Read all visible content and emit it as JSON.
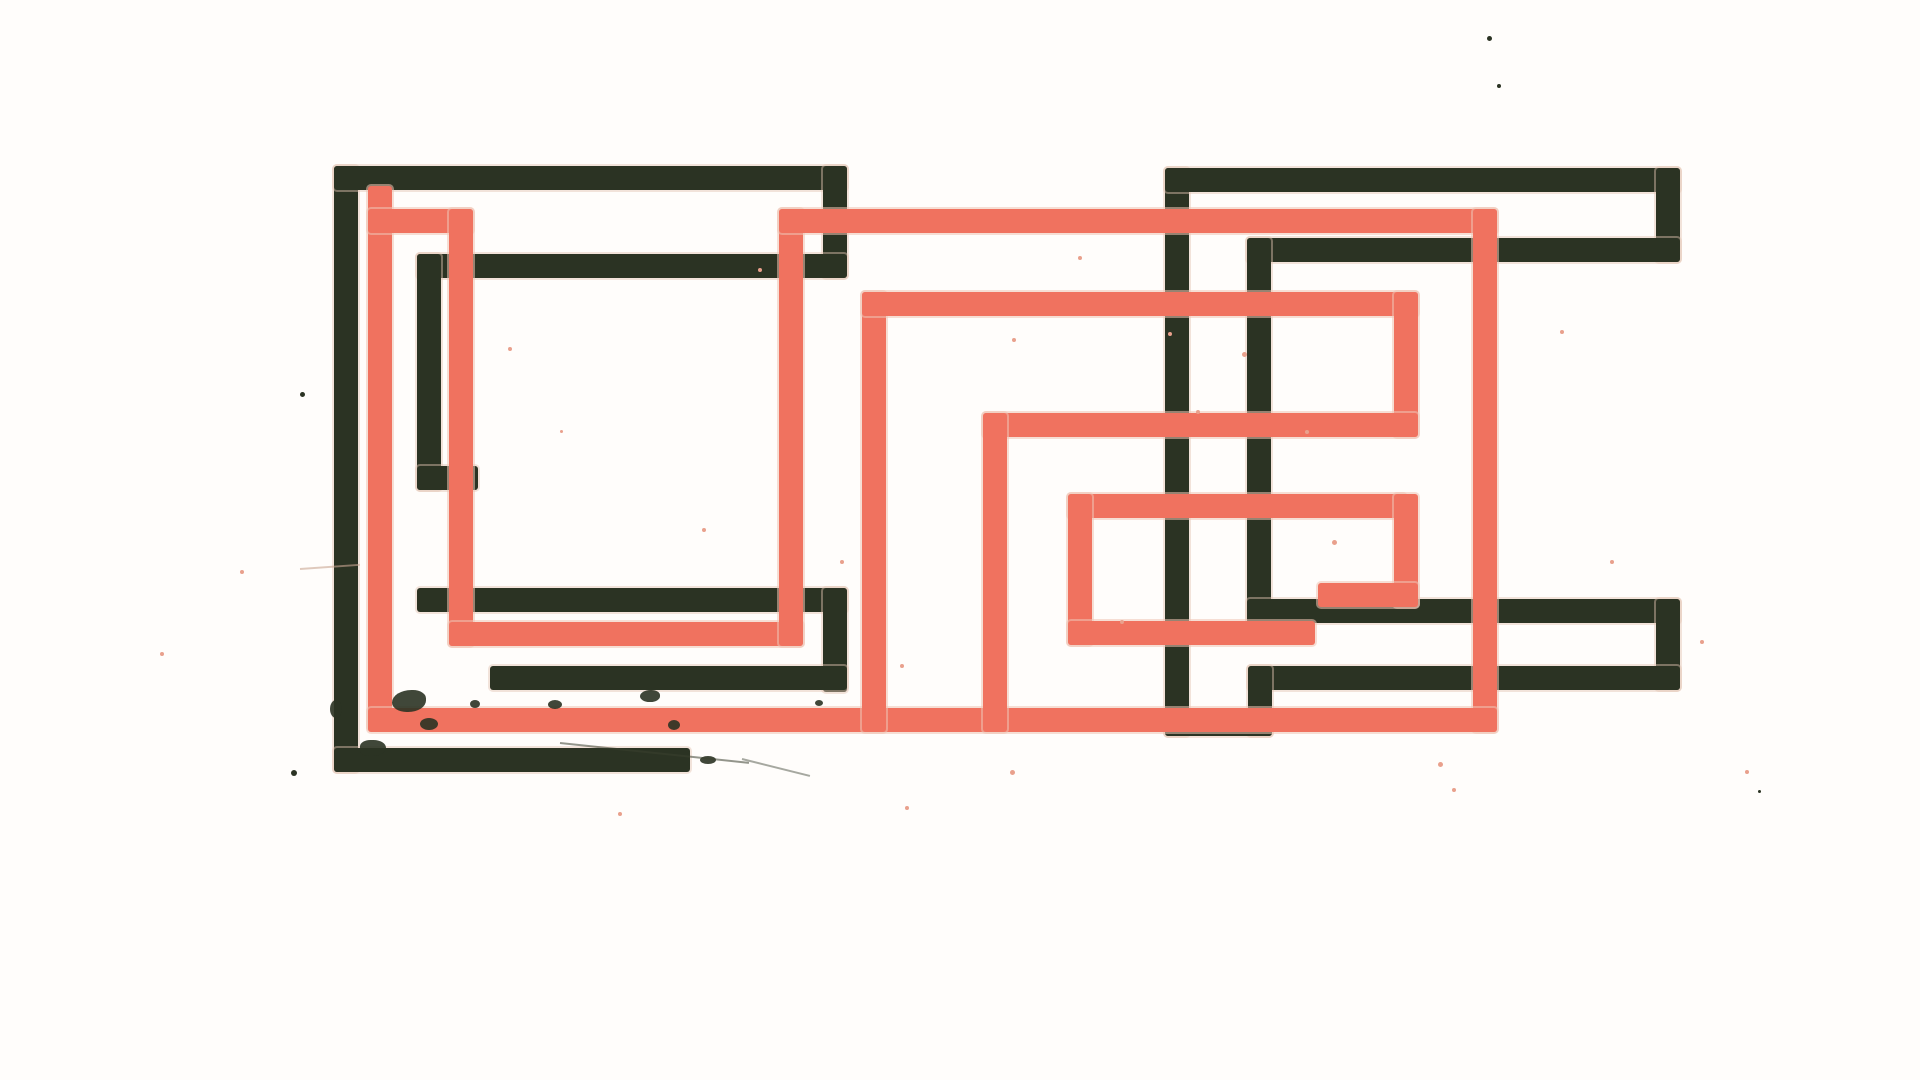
{
  "artwork": {
    "title": "abstract-geometric-meander-print",
    "canvas": {
      "width": 1920,
      "height": 1080,
      "background": "#fffdfb"
    },
    "colors": {
      "dark": "#2b3323",
      "salmon": "#f0725f",
      "halo": "#eec5b4",
      "speckle_pink": "#e9a08c"
    },
    "stroke_thickness": 24,
    "segments": [
      {
        "glyph": "left-dark",
        "color": "dark",
        "x": 334,
        "y": 166,
        "w": 24,
        "h": 606
      },
      {
        "glyph": "left-dark",
        "color": "dark",
        "x": 334,
        "y": 166,
        "w": 513,
        "h": 24
      },
      {
        "glyph": "left-dark",
        "color": "dark",
        "x": 823,
        "y": 166,
        "w": 24,
        "h": 112
      },
      {
        "glyph": "left-dark",
        "color": "dark",
        "x": 417,
        "y": 254,
        "w": 430,
        "h": 24
      },
      {
        "glyph": "left-dark",
        "color": "dark",
        "x": 417,
        "y": 254,
        "w": 24,
        "h": 236
      },
      {
        "glyph": "left-dark",
        "color": "dark",
        "x": 417,
        "y": 466,
        "w": 61,
        "h": 24
      },
      {
        "glyph": "left-dark",
        "color": "dark",
        "x": 417,
        "y": 588,
        "w": 430,
        "h": 24
      },
      {
        "glyph": "left-dark",
        "color": "dark",
        "x": 823,
        "y": 588,
        "w": 24,
        "h": 104
      },
      {
        "glyph": "left-dark",
        "color": "dark",
        "x": 490,
        "y": 666,
        "w": 357,
        "h": 24
      },
      {
        "glyph": "left-dark",
        "color": "dark",
        "x": 334,
        "y": 748,
        "w": 356,
        "h": 24
      },
      {
        "glyph": "right-dark",
        "color": "dark",
        "x": 1165,
        "y": 168,
        "w": 24,
        "h": 568
      },
      {
        "glyph": "right-dark",
        "color": "dark",
        "x": 1165,
        "y": 168,
        "w": 515,
        "h": 24
      },
      {
        "glyph": "right-dark",
        "color": "dark",
        "x": 1656,
        "y": 168,
        "w": 24,
        "h": 94
      },
      {
        "glyph": "right-dark",
        "color": "dark",
        "x": 1247,
        "y": 238,
        "w": 433,
        "h": 24
      },
      {
        "glyph": "right-dark",
        "color": "dark",
        "x": 1247,
        "y": 238,
        "w": 24,
        "h": 385
      },
      {
        "glyph": "right-dark",
        "color": "dark",
        "x": 1247,
        "y": 599,
        "w": 433,
        "h": 24
      },
      {
        "glyph": "right-dark",
        "color": "dark",
        "x": 1656,
        "y": 599,
        "w": 24,
        "h": 91
      },
      {
        "glyph": "right-dark",
        "color": "dark",
        "x": 1248,
        "y": 666,
        "w": 432,
        "h": 24
      },
      {
        "glyph": "right-dark",
        "color": "dark",
        "x": 1248,
        "y": 666,
        "w": 24,
        "h": 70
      },
      {
        "glyph": "right-dark",
        "color": "dark",
        "x": 1165,
        "y": 712,
        "w": 107,
        "h": 24
      },
      {
        "glyph": "salmon-meander",
        "color": "salmon",
        "x": 368,
        "y": 186,
        "w": 24,
        "h": 544
      },
      {
        "glyph": "salmon-meander",
        "color": "salmon",
        "x": 368,
        "y": 209,
        "w": 105,
        "h": 24
      },
      {
        "glyph": "salmon-meander",
        "color": "salmon",
        "x": 449,
        "y": 209,
        "w": 24,
        "h": 437
      },
      {
        "glyph": "salmon-meander",
        "color": "salmon",
        "x": 449,
        "y": 622,
        "w": 354,
        "h": 24
      },
      {
        "glyph": "salmon-meander",
        "color": "salmon",
        "x": 779,
        "y": 209,
        "w": 24,
        "h": 437
      },
      {
        "glyph": "salmon-meander",
        "color": "salmon",
        "x": 779,
        "y": 209,
        "w": 718,
        "h": 24
      },
      {
        "glyph": "salmon-meander",
        "color": "salmon",
        "x": 1473,
        "y": 209,
        "w": 24,
        "h": 523
      },
      {
        "glyph": "salmon-meander",
        "color": "salmon",
        "x": 368,
        "y": 708,
        "w": 1129,
        "h": 24
      },
      {
        "glyph": "salmon-meander",
        "color": "salmon",
        "x": 862,
        "y": 292,
        "w": 24,
        "h": 440
      },
      {
        "glyph": "salmon-meander",
        "color": "salmon",
        "x": 862,
        "y": 292,
        "w": 556,
        "h": 24
      },
      {
        "glyph": "salmon-meander",
        "color": "salmon",
        "x": 1394,
        "y": 292,
        "w": 24,
        "h": 145
      },
      {
        "glyph": "salmon-meander",
        "color": "salmon",
        "x": 983,
        "y": 413,
        "w": 435,
        "h": 24
      },
      {
        "glyph": "salmon-meander",
        "color": "salmon",
        "x": 983,
        "y": 413,
        "w": 24,
        "h": 319
      },
      {
        "glyph": "salmon-meander",
        "color": "salmon",
        "x": 1068,
        "y": 494,
        "w": 338,
        "h": 24
      },
      {
        "glyph": "salmon-meander",
        "color": "salmon",
        "x": 1394,
        "y": 494,
        "w": 24,
        "h": 113
      },
      {
        "glyph": "salmon-meander",
        "color": "salmon",
        "x": 1318,
        "y": 583,
        "w": 100,
        "h": 24
      },
      {
        "glyph": "salmon-meander",
        "color": "salmon",
        "x": 1068,
        "y": 494,
        "w": 24,
        "h": 151
      },
      {
        "glyph": "salmon-meander",
        "color": "salmon",
        "x": 1068,
        "y": 621,
        "w": 247,
        "h": 24
      }
    ],
    "splatters": [
      {
        "x": 392,
        "y": 690,
        "w": 34,
        "h": 22,
        "r": "60% 40% 55% 45%"
      },
      {
        "x": 420,
        "y": 718,
        "w": 18,
        "h": 12,
        "r": "50%"
      },
      {
        "x": 360,
        "y": 740,
        "w": 26,
        "h": 16,
        "r": "45% 55% 60% 40%"
      },
      {
        "x": 470,
        "y": 700,
        "w": 10,
        "h": 8,
        "r": "50%"
      },
      {
        "x": 548,
        "y": 700,
        "w": 14,
        "h": 9,
        "r": "50%"
      },
      {
        "x": 640,
        "y": 690,
        "w": 20,
        "h": 12,
        "r": "55% 45% 50% 50%"
      },
      {
        "x": 668,
        "y": 720,
        "w": 12,
        "h": 10,
        "r": "50%"
      },
      {
        "x": 700,
        "y": 756,
        "w": 16,
        "h": 8,
        "r": "50%"
      },
      {
        "x": 330,
        "y": 700,
        "w": 12,
        "h": 18,
        "r": "50%"
      },
      {
        "x": 815,
        "y": 700,
        "w": 8,
        "h": 6,
        "r": "50%"
      }
    ],
    "speckles": [
      {
        "x": 300,
        "y": 392,
        "s": 5,
        "c": "#2b3323"
      },
      {
        "x": 291,
        "y": 770,
        "s": 6,
        "c": "#2b3323"
      },
      {
        "x": 702,
        "y": 528,
        "s": 4,
        "c": "#e9a08c"
      },
      {
        "x": 758,
        "y": 268,
        "s": 4,
        "c": "#e9a08c"
      },
      {
        "x": 508,
        "y": 347,
        "s": 4,
        "c": "#e9a08c"
      },
      {
        "x": 1012,
        "y": 338,
        "s": 4,
        "c": "#e9a08c"
      },
      {
        "x": 1487,
        "y": 36,
        "s": 5,
        "c": "#2b3323"
      },
      {
        "x": 1497,
        "y": 84,
        "s": 4,
        "c": "#2b3323"
      },
      {
        "x": 1438,
        "y": 762,
        "s": 5,
        "c": "#e9a08c"
      },
      {
        "x": 1452,
        "y": 788,
        "s": 4,
        "c": "#e9a08c"
      },
      {
        "x": 1010,
        "y": 770,
        "s": 5,
        "c": "#e9a08c"
      },
      {
        "x": 1168,
        "y": 332,
        "s": 4,
        "c": "#e9a08c"
      },
      {
        "x": 1242,
        "y": 352,
        "s": 5,
        "c": "#e9a08c"
      },
      {
        "x": 1196,
        "y": 410,
        "s": 4,
        "c": "#e9a08c"
      },
      {
        "x": 1305,
        "y": 430,
        "s": 4,
        "c": "#e9a08c"
      },
      {
        "x": 1332,
        "y": 540,
        "s": 5,
        "c": "#e9a08c"
      },
      {
        "x": 1120,
        "y": 620,
        "s": 4,
        "c": "#e9a08c"
      },
      {
        "x": 900,
        "y": 664,
        "s": 4,
        "c": "#e9a08c"
      },
      {
        "x": 240,
        "y": 570,
        "s": 4,
        "c": "#e9a08c"
      },
      {
        "x": 160,
        "y": 652,
        "s": 4,
        "c": "#e9a08c"
      },
      {
        "x": 560,
        "y": 430,
        "s": 3,
        "c": "#e9a08c"
      },
      {
        "x": 840,
        "y": 560,
        "s": 4,
        "c": "#e9a08c"
      },
      {
        "x": 1078,
        "y": 256,
        "s": 4,
        "c": "#e9a08c"
      },
      {
        "x": 1560,
        "y": 330,
        "s": 4,
        "c": "#e9a08c"
      },
      {
        "x": 1610,
        "y": 560,
        "s": 4,
        "c": "#e9a08c"
      },
      {
        "x": 1700,
        "y": 640,
        "s": 4,
        "c": "#e9a08c"
      },
      {
        "x": 1745,
        "y": 770,
        "s": 4,
        "c": "#e9a08c"
      },
      {
        "x": 1758,
        "y": 790,
        "s": 3,
        "c": "#2b3323"
      },
      {
        "x": 618,
        "y": 812,
        "s": 4,
        "c": "#e9a08c"
      },
      {
        "x": 905,
        "y": 806,
        "s": 4,
        "c": "#e9a08c"
      }
    ],
    "scratches": [
      {
        "x": 560,
        "y": 742,
        "len": 190,
        "rot": 6,
        "c": "#3a4030",
        "o": 0.55
      },
      {
        "x": 742,
        "y": 758,
        "len": 70,
        "rot": 14,
        "c": "#3a4030",
        "o": 0.45
      },
      {
        "x": 300,
        "y": 568,
        "len": 60,
        "rot": -4,
        "c": "#caa693",
        "o": 0.6
      }
    ]
  }
}
